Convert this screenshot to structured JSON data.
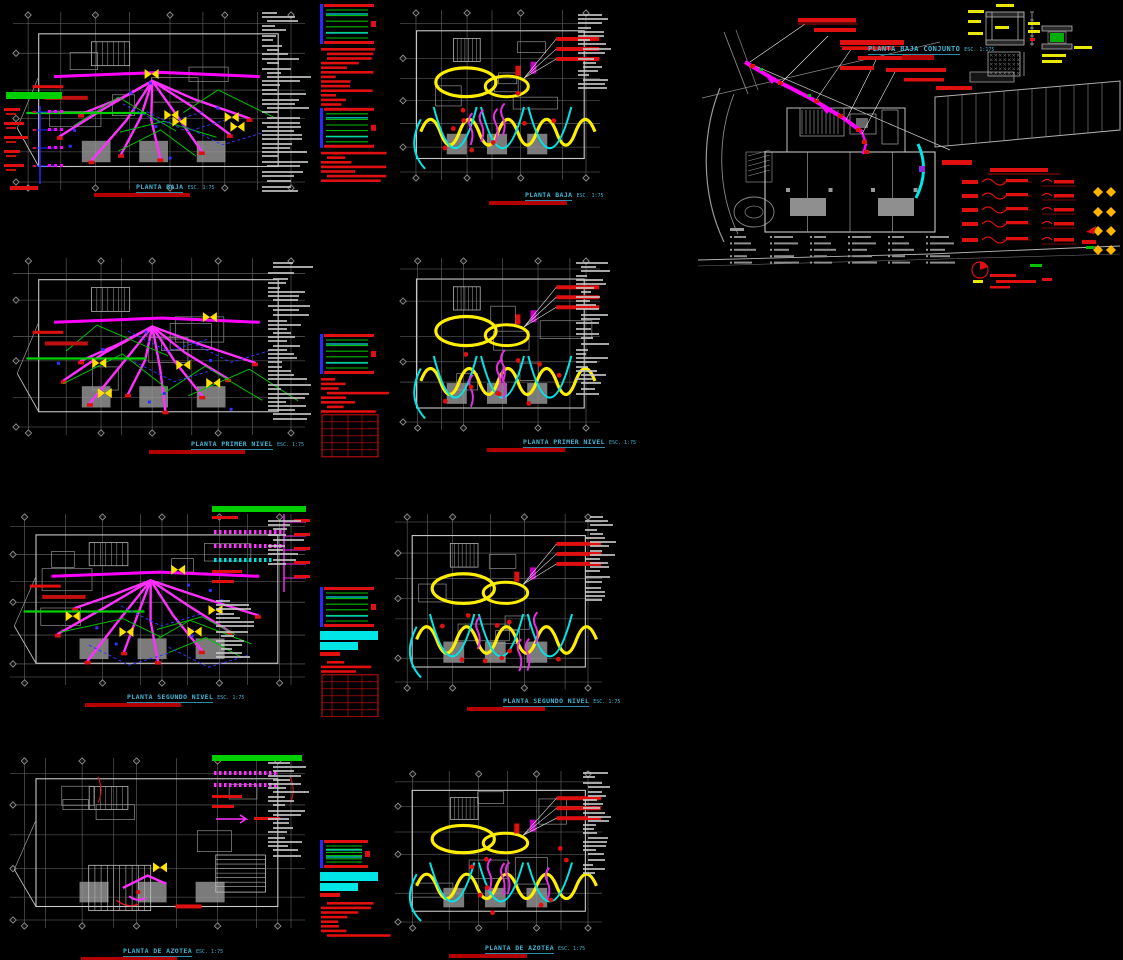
{
  "drawing": {
    "plans": [
      {
        "title": "PLANTA BAJA",
        "scale": "ESC. 1:75"
      },
      {
        "title": "PLANTA BAJA",
        "scale": "ESC. 1:75"
      },
      {
        "title": "PLANTA PRIMER NIVEL",
        "scale": "ESC. 1:75"
      },
      {
        "title": "PLANTA PRIMER NIVEL",
        "scale": "ESC. 1:75"
      },
      {
        "title": "PLANTA SEGUNDO NIVEL",
        "scale": "ESC. 1:75"
      },
      {
        "title": "PLANTA SEGUNDO NIVEL",
        "scale": "ESC. 1:75"
      },
      {
        "title": "PLANTA DE AZOTEA",
        "scale": "ESC. 1:75"
      },
      {
        "title": "PLANTA DE AZOTEA",
        "scale": "ESC. 1:75"
      }
    ],
    "site": {
      "title": "PLANTA BAJA CONJUNTO",
      "scale": "ESC. 1:175"
    }
  },
  "colors": {
    "background": "#000000",
    "wire_magenta": "#FF00FF",
    "wire_yellow": "#FFEE00",
    "wire_cyan": "#00E5E5",
    "wire_green": "#00C000",
    "wire_blue": "#3030FF",
    "annotation_red": "#E01010",
    "grid_gray": "#6D6D6D",
    "outline_gray": "#C9C9C9",
    "title_cyan": "#3FB9D9",
    "title_bar_red": "#B40000",
    "legend_green": "#00D000",
    "diamond_yellow": "#FFB400",
    "notes_gray": "#C9C9C9"
  }
}
